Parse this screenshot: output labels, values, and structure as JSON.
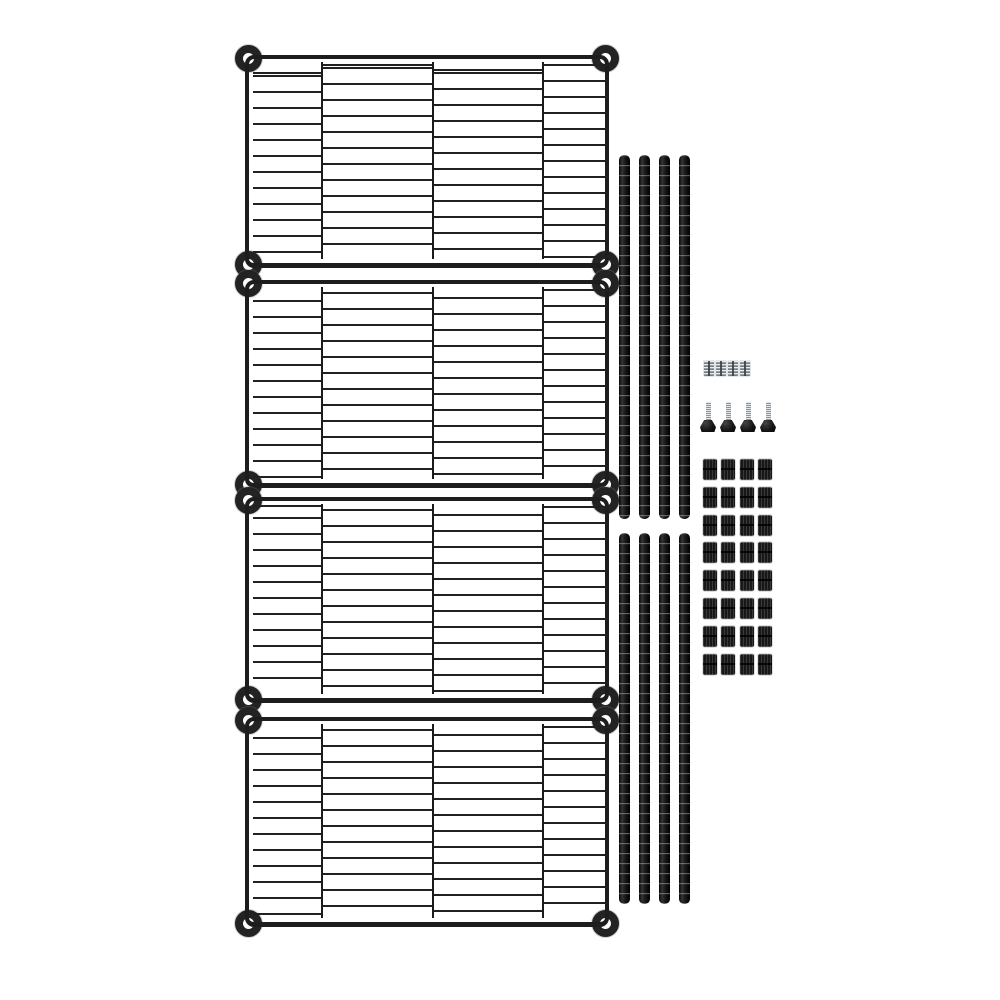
{
  "description": "Product photo on white background: disassembled black metal wire shelving unit kit with four wire shelves, eight pole segments, four metal pole couplers, four adjustable leveling feet and thirty-two black plastic sleeve clips",
  "colors": {
    "background": "#ffffff",
    "wire": "#1d1d1d",
    "pole_dark": "#0c0c0c",
    "pole_highlight": "#383838",
    "metal_silver": "#9aa2a9",
    "metal_silver_light": "#e9edf0",
    "sleeve_plastic": "#1d1d1d"
  },
  "parts": {
    "wire_shelves": {
      "name": "wire shelf panel",
      "count": 4
    },
    "pole_segments": {
      "name": "shelf pole segment",
      "count": 8
    },
    "couplers": {
      "name": "metal pole coupler",
      "count": 4
    },
    "leveling_feet": {
      "name": "adjustable leveling foot",
      "count": 4
    },
    "sleeve_clips": {
      "name": "split sleeve clip",
      "count": 32
    }
  },
  "geometry": {
    "shelves": [
      {
        "x": 245,
        "y": 55,
        "w": 364,
        "h": 213
      },
      {
        "x": 245,
        "y": 280,
        "w": 364,
        "h": 208
      },
      {
        "x": 245,
        "y": 497,
        "w": 364,
        "h": 206
      },
      {
        "x": 245,
        "y": 717,
        "w": 364,
        "h": 210
      }
    ],
    "shelf_vwires": [
      72,
      183,
      293
    ],
    "shelf_columns": [
      {
        "left": 4,
        "width": 68,
        "lineOffset": 12
      },
      {
        "left": 74,
        "width": 109,
        "lineOffset": 4
      },
      {
        "left": 185,
        "width": 108,
        "lineOffset": 9
      },
      {
        "left": 295,
        "width": 65,
        "lineOffset": 1
      }
    ],
    "pole_groups": [
      {
        "y": 155,
        "h": 364
      },
      {
        "y": 533,
        "h": 371
      }
    ],
    "pole_xs": [
      619,
      639,
      659,
      679
    ],
    "couplers": {
      "y": 361,
      "xs": [
        704,
        716,
        728,
        740
      ]
    },
    "feet": {
      "base_xs": [
        700,
        720,
        740,
        760
      ],
      "base_y": 420,
      "base_w": 16,
      "base_h": 12,
      "stem_y": 402,
      "stem_h": 19
    },
    "sleeves": {
      "x0": 703,
      "dx": 18.3,
      "y0": 459,
      "dy": 27.8,
      "cols": 4,
      "rows": 8
    }
  }
}
